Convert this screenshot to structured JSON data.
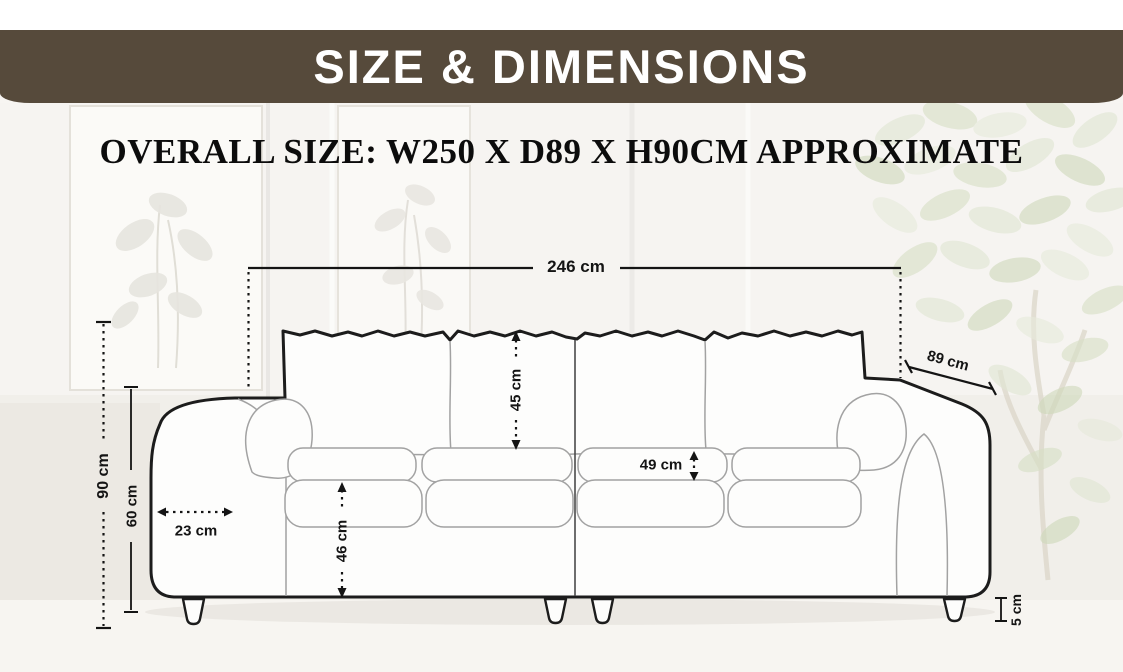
{
  "header": {
    "title": "SIZE & DIMENSIONS"
  },
  "subtitle": "OVERALL SIZE: W250 X D89 X H90CM APPROXIMATE",
  "dimensions": {
    "overall_width": "246 cm",
    "depth": "89 cm",
    "overall_height": "90 cm",
    "arm_height": "60 cm",
    "arm_width": "23 cm",
    "back_cushion_height": "45 cm",
    "seat_depth": "49 cm",
    "seat_front_height": "46 cm",
    "leg_height": "5 cm"
  },
  "colors": {
    "header_background": "#564a3b",
    "header_text": "#ffffff",
    "dimension_text": "#141414",
    "sofa_outline": "#1c1c1c",
    "sofa_inner_line": "#a2a2a2",
    "wall": "#f7f5f2",
    "plant_leaf": "#d3ddc1"
  }
}
